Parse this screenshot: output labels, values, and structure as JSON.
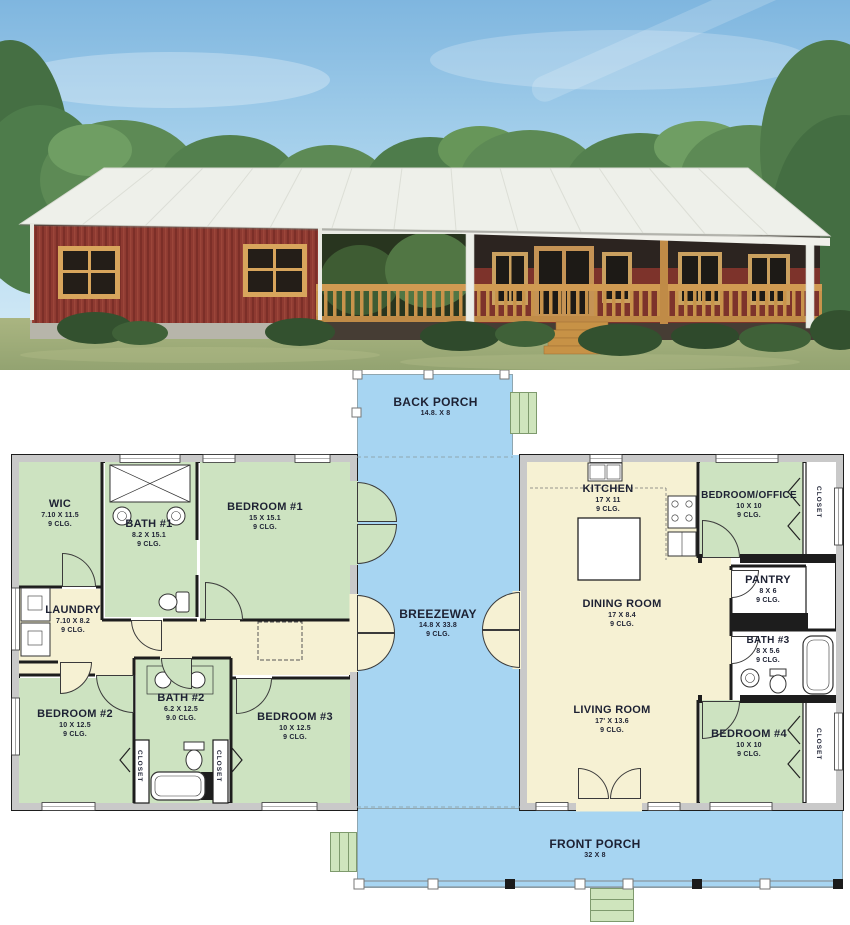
{
  "plan": {
    "porches": {
      "back_porch": {
        "name": "BACK PORCH",
        "dims": "14.8. X 8"
      },
      "breezeway": {
        "name": "BREEZEWAY",
        "dims": "14.8 X 33.8",
        "clg": "9 CLG."
      },
      "front_porch": {
        "name": "FRONT PORCH",
        "dims": "32 X 8"
      }
    },
    "rooms": {
      "wic": {
        "name": "WIC",
        "dims": "7.10 X 11.5",
        "clg": "9 CLG."
      },
      "bath1": {
        "name": "BATH #1",
        "dims": "8.2 X 15.1",
        "clg": "9 CLG."
      },
      "bedroom1": {
        "name": "BEDROOM #1",
        "dims": "15 X 15.1",
        "clg": "9 CLG."
      },
      "laundry": {
        "name": "LAUNDRY",
        "dims": "7.10 X 8.2",
        "clg": "9 CLG."
      },
      "bedroom2": {
        "name": "BEDROOM #2",
        "dims": "10 X 12.5",
        "clg": "9 CLG."
      },
      "bath2": {
        "name": "BATH #2",
        "dims": "6.2 X 12.5",
        "clg": "9.0 CLG."
      },
      "bedroom3": {
        "name": "BEDROOM #3",
        "dims": "10 X 12.5",
        "clg": "9 CLG."
      },
      "kitchen": {
        "name": "KITCHEN",
        "dims": "17 X 11",
        "clg": "9 CLG."
      },
      "dining": {
        "name": "DINING ROOM",
        "dims": "17 X 8.4",
        "clg": "9 CLG."
      },
      "living": {
        "name": "LIVING ROOM",
        "dims": "17' X 13.6",
        "clg": "9 CLG."
      },
      "bedroom_office": {
        "name": "BEDROOM/OFFICE",
        "dims": "10 X 10",
        "clg": "9 CLG."
      },
      "pantry": {
        "name": "PANTRY",
        "dims": "8 X 6",
        "clg": "9 CLG."
      },
      "bath3": {
        "name": "BATH #3",
        "dims": "8 X 5.6",
        "clg": "9 CLG."
      },
      "bedroom4": {
        "name": "BEDROOM #4",
        "dims": "10 X 10",
        "clg": "9 CLG."
      }
    },
    "closet_label": "CLOSET"
  },
  "colors": {
    "porch_blue": "#a7d5f2",
    "room_green": "#cde3c1",
    "room_cream": "#f6f1d3",
    "wall_black": "#1d1d1d",
    "wall_gray": "#c9c9c9",
    "stairs_green": "#cfe5bd",
    "label_ink": "#1d2133",
    "house_red": "#8e3a31",
    "roof_white": "#eef0ea",
    "wood_tan": "#cf9a52",
    "sky_blue": "#9ccbea",
    "grass_green": "#a3af7c",
    "tree_green": "#55824f"
  }
}
